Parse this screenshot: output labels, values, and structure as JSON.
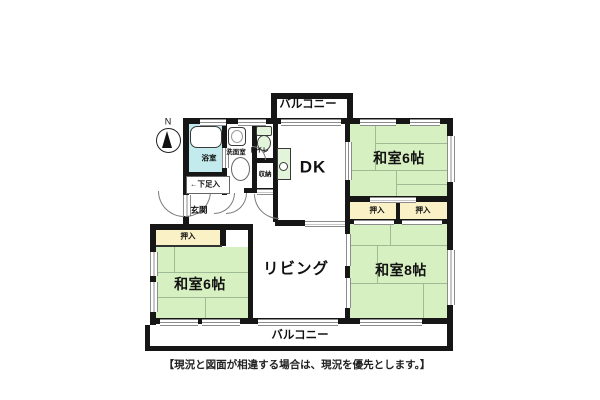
{
  "floorplan": {
    "north": "N",
    "balcony_top": {
      "label": "バルコニー"
    },
    "balcony_bottom": {
      "label": "バルコニー"
    },
    "rooms": {
      "dk": {
        "label": "DK"
      },
      "living": {
        "label": "リビング"
      },
      "tatami6_top": {
        "label": "和室6帖"
      },
      "tatami6_left": {
        "label": "和室6帖"
      },
      "tatami8": {
        "label": "和室8帖"
      }
    },
    "service": {
      "bath": {
        "label": "浴室"
      },
      "washroom": {
        "label": "洗面室"
      },
      "toilet": {
        "label": "トイレ"
      },
      "storage": {
        "label": "収納"
      },
      "entrance": {
        "label": "玄関"
      },
      "shoe_cabinet": {
        "label": "←下足入"
      }
    },
    "closets": [
      {
        "label": "押入"
      },
      {
        "label": "押入"
      },
      {
        "label": "押入"
      }
    ],
    "disclaimer": "【現況と図面が相違する場合は、現況を優先とします。】",
    "colors": {
      "wall": "#161616",
      "tatami": "#d7f0c1",
      "closet": "#fbf1c6",
      "bath": "#c3ebee",
      "fixture": "#e2f4da",
      "grid": "#9fbb93",
      "line": "#8c8c8c"
    }
  }
}
